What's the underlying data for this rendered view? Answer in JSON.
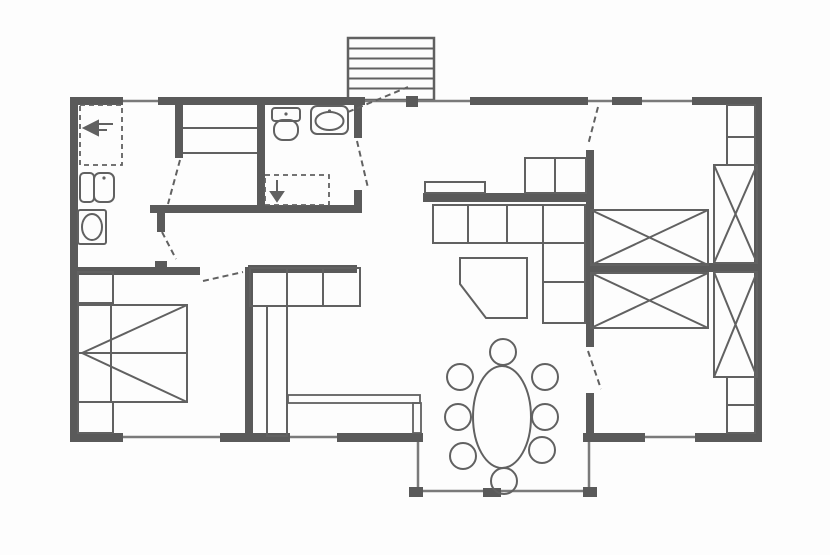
{
  "canvas": {
    "w": 830,
    "h": 555,
    "bg": "#fdfdfd",
    "colors": {
      "wall": "#5a5a5a",
      "line": "#616161",
      "thin": "#7a7a7a"
    }
  },
  "stairs": {
    "name": "entrance-stairs",
    "x": 348,
    "y": 38,
    "w": 86,
    "h": 62,
    "treads": [
      48.5,
      58.5,
      68.5,
      78.5,
      88.5
    ]
  },
  "walls": [
    {
      "name": "wall-top-1",
      "r": [
        70,
        97,
        53,
        8
      ]
    },
    {
      "name": "wall-top-2",
      "r": [
        158,
        97,
        207,
        8
      ]
    },
    {
      "name": "wall-top-3",
      "r": [
        470,
        97,
        118,
        8
      ]
    },
    {
      "name": "wall-top-4",
      "r": [
        612,
        97,
        30,
        8
      ]
    },
    {
      "name": "wall-top-5",
      "r": [
        692,
        97,
        70,
        8
      ]
    },
    {
      "name": "wall-left",
      "r": [
        70,
        97,
        8,
        345
      ]
    },
    {
      "name": "wall-right",
      "r": [
        754,
        97,
        8,
        345
      ]
    },
    {
      "name": "wall-bottom-1",
      "r": [
        70,
        433,
        53,
        9
      ]
    },
    {
      "name": "wall-bottom-2",
      "r": [
        220,
        433,
        70,
        9
      ]
    },
    {
      "name": "wall-bottom-3",
      "r": [
        337,
        433,
        73,
        9
      ]
    },
    {
      "name": "wall-bottom-4",
      "r": [
        593,
        433,
        52,
        9
      ]
    },
    {
      "name": "wall-bottom-5",
      "r": [
        695,
        433,
        67,
        9
      ]
    },
    {
      "name": "wall-hall-top",
      "r": [
        150,
        205,
        212,
        8
      ]
    },
    {
      "name": "wall-closet-left",
      "r": [
        175,
        105,
        8,
        53
      ]
    },
    {
      "name": "wall-bath-left",
      "r": [
        257,
        105,
        8,
        100
      ]
    },
    {
      "name": "wall-bath-right-upper",
      "r": [
        354,
        105,
        8,
        33
      ]
    },
    {
      "name": "wall-bath-right-lower",
      "r": [
        354,
        190,
        8,
        23
      ]
    },
    {
      "name": "wall-utility-stub",
      "r": [
        157,
        213,
        8,
        19
      ]
    },
    {
      "name": "wall-bedroom1-top",
      "r": [
        70,
        267,
        130,
        8
      ]
    },
    {
      "name": "wall-bedroom1-tick",
      "r": [
        155,
        261,
        12,
        6
      ]
    },
    {
      "name": "wall-kitchen-west",
      "r": [
        245,
        267,
        8,
        170
      ]
    },
    {
      "name": "wall-kitchen-north",
      "r": [
        248,
        265,
        109,
        8
      ]
    },
    {
      "name": "wall-hall-living-bar",
      "r": [
        423,
        193,
        165,
        9
      ]
    },
    {
      "name": "wall-divider-upper",
      "r": [
        586,
        150,
        8,
        197
      ]
    },
    {
      "name": "wall-divider-lower",
      "r": [
        586,
        393,
        8,
        48
      ]
    },
    {
      "name": "entrance-door-block",
      "r": [
        406,
        96,
        12,
        11
      ]
    },
    {
      "name": "bay-post-top-left",
      "r": [
        409,
        433,
        14,
        9
      ]
    },
    {
      "name": "bay-post-bottom-left",
      "r": [
        409,
        487,
        14,
        10
      ]
    },
    {
      "name": "bay-post-top-right",
      "r": [
        583,
        433,
        14,
        9
      ]
    },
    {
      "name": "bay-post-bottom-right",
      "r": [
        583,
        487,
        14,
        10
      ]
    },
    {
      "name": "bay-center-block",
      "r": [
        483,
        488,
        18,
        9
      ]
    },
    {
      "name": "wardrobe-divider-bar",
      "r": [
        591,
        263,
        166,
        9
      ]
    }
  ],
  "windows": [
    {
      "name": "window-top-left",
      "p": [
        123,
        101,
        158,
        101
      ]
    },
    {
      "name": "opening-entrance",
      "p": [
        365,
        101,
        470,
        101
      ]
    },
    {
      "name": "opening-bedroom2",
      "p": [
        588,
        101,
        612,
        101
      ]
    },
    {
      "name": "window-top-right",
      "p": [
        642,
        101,
        692,
        101
      ]
    },
    {
      "name": "window-bottom-left",
      "p": [
        123,
        437,
        220,
        437
      ]
    },
    {
      "name": "window-kitchen",
      "p": [
        290,
        437,
        337,
        437
      ]
    },
    {
      "name": "window-bottom-right",
      "p": [
        645,
        437,
        695,
        437
      ]
    },
    {
      "name": "window-bay-left",
      "p": [
        418,
        441,
        418,
        489
      ]
    },
    {
      "name": "window-bay-right",
      "p": [
        589,
        441,
        589,
        489
      ]
    },
    {
      "name": "window-bay-bottom",
      "p": [
        423,
        491,
        585,
        491
      ]
    }
  ],
  "doors": [
    {
      "name": "door-entrance-leaf",
      "p": [
        348,
        112,
        408,
        87
      ]
    },
    {
      "name": "door-bathroom-leaf",
      "p": [
        357,
        141,
        368,
        188
      ]
    },
    {
      "name": "door-closet-leaf",
      "p": [
        180,
        160,
        168,
        204
      ]
    },
    {
      "name": "door-utility-leaf",
      "p": [
        162,
        232,
        176,
        259
      ]
    },
    {
      "name": "door-bedroom1-leaf",
      "p": [
        203,
        281,
        243,
        272
      ]
    },
    {
      "name": "door-bedroom2-top-leaf",
      "p": [
        598,
        107,
        588,
        145
      ]
    },
    {
      "name": "door-bedroom2-bottom-leaf",
      "p": [
        588,
        351,
        601,
        389
      ]
    }
  ],
  "thin_partitions": [
    {
      "name": "kitchen-partition-horizontal",
      "r": [
        288,
        395,
        132,
        8
      ]
    },
    {
      "name": "kitchen-partition-vertical",
      "r": [
        413,
        403,
        8,
        30
      ]
    }
  ],
  "furniture": [
    {
      "type": "dashedrect",
      "name": "utility-appliance-space",
      "r": [
        80,
        105,
        42,
        60
      ]
    },
    {
      "type": "polygon",
      "name": "utility-arrow-symbol",
      "fill": true,
      "points": [
        [
          84,
          128
        ],
        [
          98,
          121
        ],
        [
          98,
          135
        ]
      ]
    },
    {
      "type": "line",
      "name": "utility-arrow-line-1",
      "p": [
        98,
        124,
        113,
        124
      ]
    },
    {
      "type": "line",
      "name": "utility-arrow-line-2",
      "p": [
        98,
        130,
        107,
        130
      ]
    },
    {
      "type": "rect",
      "name": "laundry-fixture-left",
      "r": [
        80,
        173,
        14,
        29
      ],
      "rx": 4
    },
    {
      "type": "rect",
      "name": "laundry-fixture-right",
      "r": [
        94,
        173,
        20,
        29
      ],
      "rx": 6
    },
    {
      "type": "dot",
      "name": "laundry-fixture-dot",
      "c": [
        104,
        178
      ],
      "r": 1.6
    },
    {
      "type": "rect",
      "name": "washing-machine",
      "r": [
        78,
        210,
        28,
        34
      ],
      "rx": 2
    },
    {
      "type": "ellipse",
      "name": "washing-machine-drum",
      "c": [
        92,
        227
      ],
      "rr": [
        10,
        13
      ]
    },
    {
      "type": "line",
      "name": "closet-shelf-1",
      "p": [
        183,
        128,
        257,
        128
      ]
    },
    {
      "type": "line",
      "name": "closet-shelf-2",
      "p": [
        183,
        153,
        257,
        153
      ]
    },
    {
      "type": "rect",
      "name": "toilet-cistern",
      "r": [
        272,
        108,
        28,
        13
      ],
      "rx": 3
    },
    {
      "type": "rect",
      "name": "toilet-bowl",
      "r": [
        274,
        120,
        24,
        20
      ],
      "rx": 9
    },
    {
      "type": "dot",
      "name": "toilet-dot",
      "c": [
        286,
        114
      ],
      "r": 1.6
    },
    {
      "type": "rect",
      "name": "washbasin",
      "r": [
        311,
        106,
        37,
        28
      ],
      "rx": 6
    },
    {
      "type": "ellipse",
      "name": "washbasin-bowl",
      "c": [
        329.5,
        121
      ],
      "rr": [
        14,
        9
      ]
    },
    {
      "type": "dot",
      "name": "washbasin-dot",
      "c": [
        329.5,
        111
      ],
      "r": 1.6
    },
    {
      "type": "dashedrect",
      "name": "shower-area",
      "r": [
        265,
        175,
        64,
        30
      ]
    },
    {
      "type": "polygon",
      "name": "shower-symbol",
      "fill": true,
      "points": [
        [
          271,
          192
        ],
        [
          283,
          192
        ],
        [
          277,
          201
        ]
      ]
    },
    {
      "type": "line",
      "name": "shower-symbol-stem",
      "p": [
        277,
        180,
        277,
        192
      ]
    },
    {
      "type": "rect",
      "name": "hall-shelf",
      "r": [
        425,
        182,
        60,
        11
      ]
    },
    {
      "type": "rect",
      "name": "hall-cabinet",
      "r": [
        525,
        158,
        61,
        35
      ],
      "dv": [
        555
      ]
    },
    {
      "type": "rect",
      "name": "kitchen-counter-top",
      "r": [
        250,
        268,
        110,
        38
      ],
      "dv": [
        287,
        323
      ]
    },
    {
      "type": "rect",
      "name": "kitchen-counter-side",
      "r": [
        267,
        306,
        20,
        130
      ]
    },
    {
      "type": "rect",
      "name": "sofa-seats",
      "r": [
        433,
        205,
        152,
        38
      ],
      "dv": [
        468,
        507,
        543
      ]
    },
    {
      "type": "rect",
      "name": "sofa-chaise",
      "r": [
        543,
        243,
        42,
        80
      ],
      "dh": [
        282
      ]
    },
    {
      "type": "polygon",
      "name": "coffee-table",
      "fill": false,
      "points": [
        [
          460,
          258
        ],
        [
          527,
          258
        ],
        [
          527,
          318
        ],
        [
          486,
          318
        ],
        [
          460,
          284
        ]
      ]
    },
    {
      "type": "ellipse",
      "name": "dining-table",
      "c": [
        502,
        417
      ],
      "rr": [
        29,
        51
      ]
    },
    {
      "type": "circle",
      "name": "dining-chair-top",
      "c": [
        503,
        352
      ],
      "r": 13
    },
    {
      "type": "circle",
      "name": "dining-chair-left-1",
      "c": [
        460,
        377
      ],
      "r": 13
    },
    {
      "type": "circle",
      "name": "dining-chair-left-2",
      "c": [
        458,
        417
      ],
      "r": 13
    },
    {
      "type": "circle",
      "name": "dining-chair-left-3",
      "c": [
        463,
        456
      ],
      "r": 13
    },
    {
      "type": "circle",
      "name": "dining-chair-right-1",
      "c": [
        545,
        377
      ],
      "r": 13
    },
    {
      "type": "circle",
      "name": "dining-chair-right-2",
      "c": [
        545,
        417
      ],
      "r": 13
    },
    {
      "type": "circle",
      "name": "dining-chair-right-3",
      "c": [
        542,
        450
      ],
      "r": 13
    },
    {
      "type": "circle",
      "name": "dining-chair-bottom",
      "c": [
        504,
        481
      ],
      "r": 13
    },
    {
      "type": "rect",
      "name": "nightstand-top",
      "r": [
        78,
        272,
        35,
        31
      ]
    },
    {
      "type": "rect",
      "name": "nightstand-bottom",
      "r": [
        78,
        402,
        35,
        31
      ]
    },
    {
      "type": "rect",
      "name": "double-bed",
      "r": [
        78,
        305,
        109,
        97
      ]
    },
    {
      "type": "line",
      "name": "bed-midline",
      "p": [
        78,
        353,
        187,
        353
      ]
    },
    {
      "type": "line",
      "name": "bed-pillow-line",
      "p": [
        111,
        305,
        111,
        402
      ]
    },
    {
      "type": "line",
      "name": "bed-diagonal-1",
      "p": [
        187,
        305,
        82,
        353
      ]
    },
    {
      "type": "line",
      "name": "bed-diagonal-2",
      "p": [
        187,
        402,
        82,
        353
      ]
    },
    {
      "type": "xbox",
      "name": "wardrobe-x-upper",
      "r": [
        591,
        210,
        117,
        55
      ]
    },
    {
      "type": "xbox",
      "name": "wardrobe-x-lower",
      "r": [
        591,
        273,
        117,
        55
      ]
    },
    {
      "type": "xbox",
      "name": "wardrobe-x-right-upper",
      "r": [
        714,
        165,
        43,
        98
      ]
    },
    {
      "type": "xbox",
      "name": "wardrobe-x-right-lower",
      "r": [
        714,
        272,
        43,
        105
      ]
    },
    {
      "type": "rect",
      "name": "corner-shelf-unit-top",
      "r": [
        727,
        105,
        28,
        60
      ],
      "dh": [
        137
      ]
    },
    {
      "type": "rect",
      "name": "corner-shelf-unit-bottom",
      "r": [
        727,
        377,
        28,
        56
      ],
      "dh": [
        405
      ]
    }
  ]
}
